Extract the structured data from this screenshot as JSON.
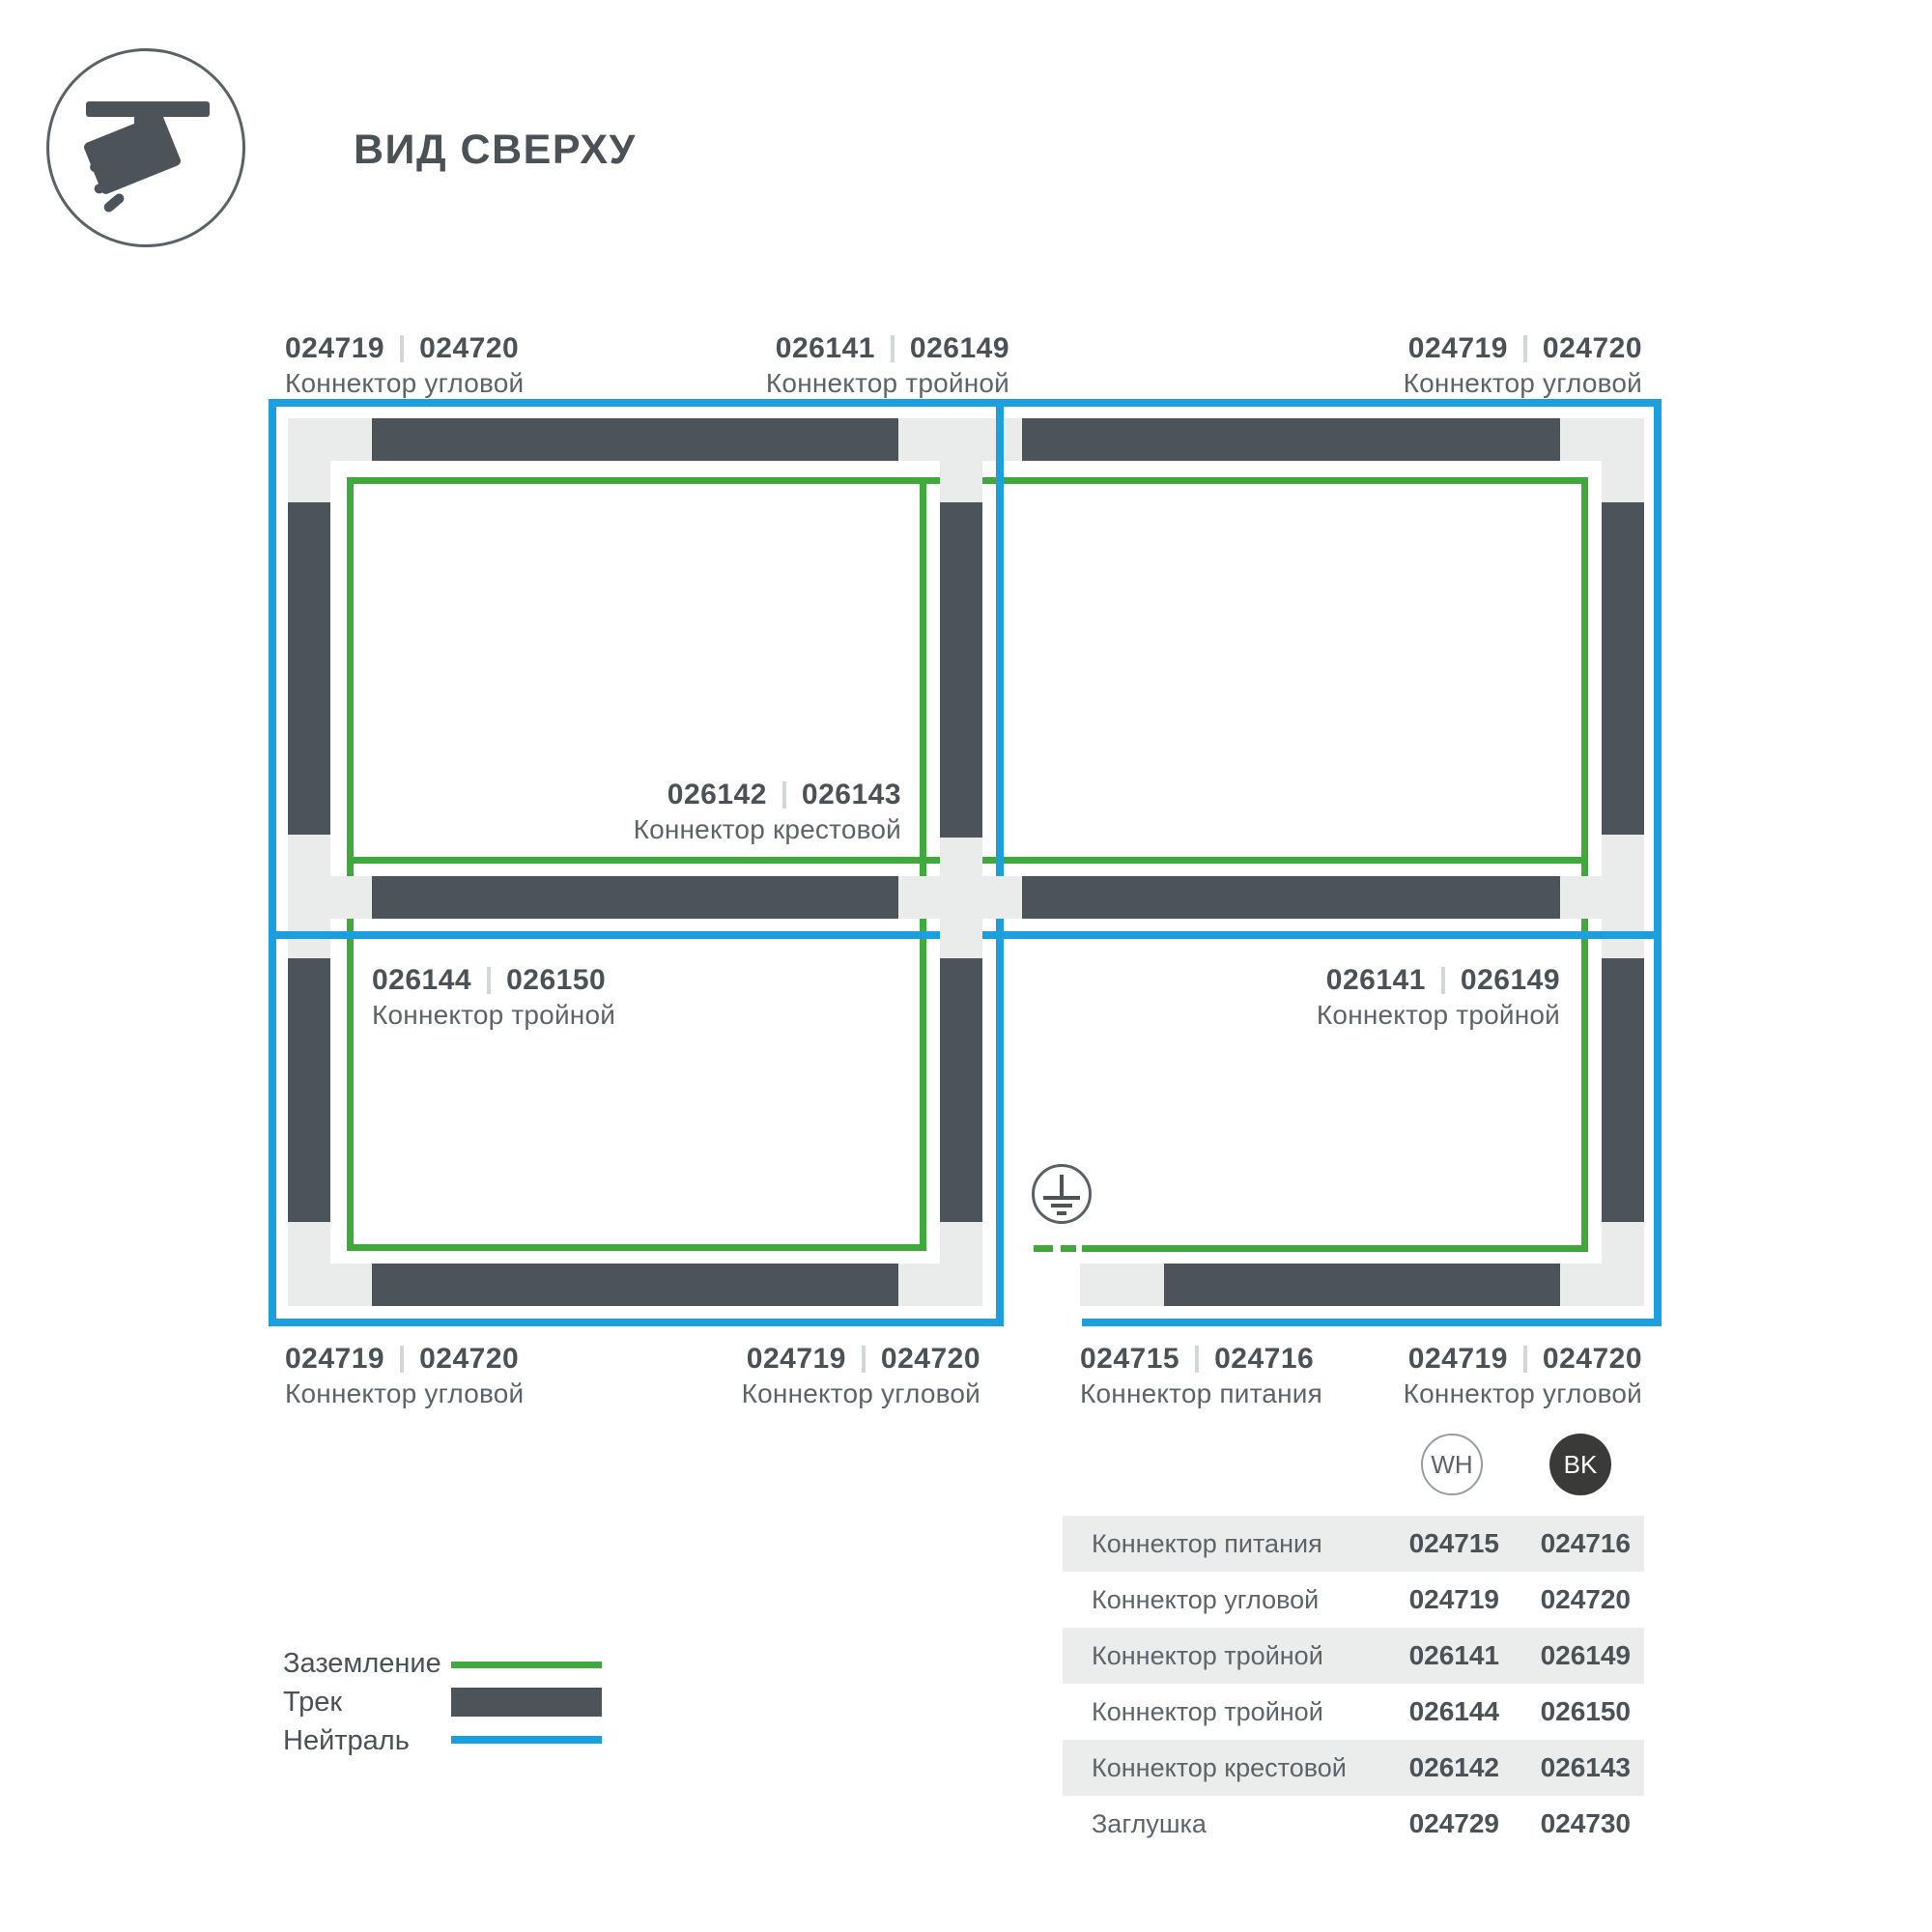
{
  "page": {
    "title": "ВИД СВЕРХУ"
  },
  "icons": {
    "logo": "track-spotlight-icon",
    "ground": "earth-ground-icon",
    "wh_badge": "white-variant-badge",
    "bk_badge": "black-variant-badge"
  },
  "diagram": {
    "labels": [
      {
        "wh": "024719",
        "bk": "024720",
        "name": "Коннектор угловой"
      },
      {
        "wh": "026141",
        "bk": "026149",
        "name": "Коннектор тройной"
      },
      {
        "wh": "024719",
        "bk": "024720",
        "name": "Коннектор угловой"
      },
      {
        "wh": "026142",
        "bk": "026143",
        "name": "Коннектор крестовой"
      },
      {
        "wh": "026144",
        "bk": "026150",
        "name": "Коннектор тройной"
      },
      {
        "wh": "026141",
        "bk": "026149",
        "name": "Коннектор тройной"
      },
      {
        "wh": "024719",
        "bk": "024720",
        "name": "Коннектор угловой"
      },
      {
        "wh": "024719",
        "bk": "024720",
        "name": "Коннектор угловой"
      },
      {
        "wh": "024715",
        "bk": "024716",
        "name": "Коннектор питания"
      },
      {
        "wh": "024719",
        "bk": "024720",
        "name": "Коннектор угловой"
      }
    ]
  },
  "legend": {
    "items": [
      {
        "label": "Заземление",
        "swatch": "ground-line",
        "color": "#3fa93c"
      },
      {
        "label": "Трек",
        "swatch": "track-bar",
        "color": "#4c545a"
      },
      {
        "label": "Нейтраль",
        "swatch": "neutral-line",
        "color": "#1c9fde"
      }
    ]
  },
  "table": {
    "columns": [
      {
        "code": "WH"
      },
      {
        "code": "BK"
      }
    ],
    "rows": [
      {
        "name": "Коннектор питания",
        "wh": "024715",
        "bk": "024716"
      },
      {
        "name": "Коннектор угловой",
        "wh": "024719",
        "bk": "024720"
      },
      {
        "name": "Коннектор тройной",
        "wh": "026141",
        "bk": "026149"
      },
      {
        "name": "Коннектор тройной",
        "wh": "026144",
        "bk": "026150"
      },
      {
        "name": "Коннектор крестовой",
        "wh": "026142",
        "bk": "026143"
      },
      {
        "name": "Заглушка",
        "wh": "024729",
        "bk": "024730"
      }
    ]
  },
  "colors": {
    "track": "#4c545a",
    "connector_block": "#e9eceb",
    "ground_green": "#3fa93c",
    "neutral_blue": "#1c9fde",
    "text_bold": "#4a5157",
    "text_label": "#5d6469",
    "divider": "#d4d7d8",
    "row_bg": "#eaedec",
    "bk_badge": "#3a3a38"
  }
}
